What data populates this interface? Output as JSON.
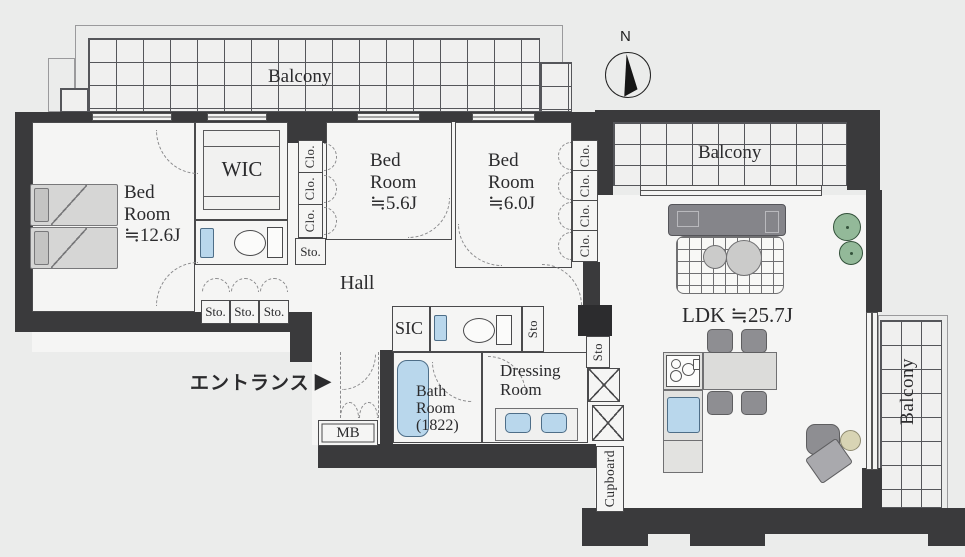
{
  "colors": {
    "background": "#ebeceb",
    "wall": "#3a3a3c",
    "wall-dark": "#2c2c2e",
    "floor": "#f5f5f4",
    "line": "#4a4a4c",
    "water": "#b9d7ec",
    "furniture": "#d6d6d5",
    "sofa": "#85858a",
    "chair": "#8e8e92",
    "plant": "#93b999",
    "beige": "#d8d4b4",
    "text": "#2b2b2d"
  },
  "compass": {
    "north_label": "N"
  },
  "balconies": {
    "top": {
      "label": "Balcony"
    },
    "upper_right": {
      "label": "Balcony"
    },
    "right": {
      "label": "Balcony"
    }
  },
  "rooms": {
    "bedroom_main": {
      "name_line1": "Bed",
      "name_line2": "Room",
      "size": "≒12.6J"
    },
    "bedroom_mid": {
      "name_line1": "Bed",
      "name_line2": "Room",
      "size": "≒5.6J"
    },
    "bedroom_right": {
      "name_line1": "Bed",
      "name_line2": "Room",
      "size": "≒6.0J"
    },
    "wic": {
      "label": "WIC"
    },
    "hall": {
      "label": "Hall"
    },
    "sic": {
      "label": "SIC"
    },
    "bath": {
      "name_line1": "Bath",
      "name_line2": "Room",
      "dimension": "(1822)"
    },
    "dressing": {
      "name_line1": "Dressing",
      "name_line2": "Room"
    },
    "ldk": {
      "name": "LDK",
      "size": "≒25.7J"
    },
    "cupboard": {
      "label": "Cupboard"
    },
    "mb": {
      "label": "MB"
    }
  },
  "storage_labels": {
    "closet": "Clo.",
    "storage": "Sto.",
    "storage_vertical": "Sto"
  },
  "entrance": {
    "label": "エントランス",
    "arrow": "▶"
  }
}
